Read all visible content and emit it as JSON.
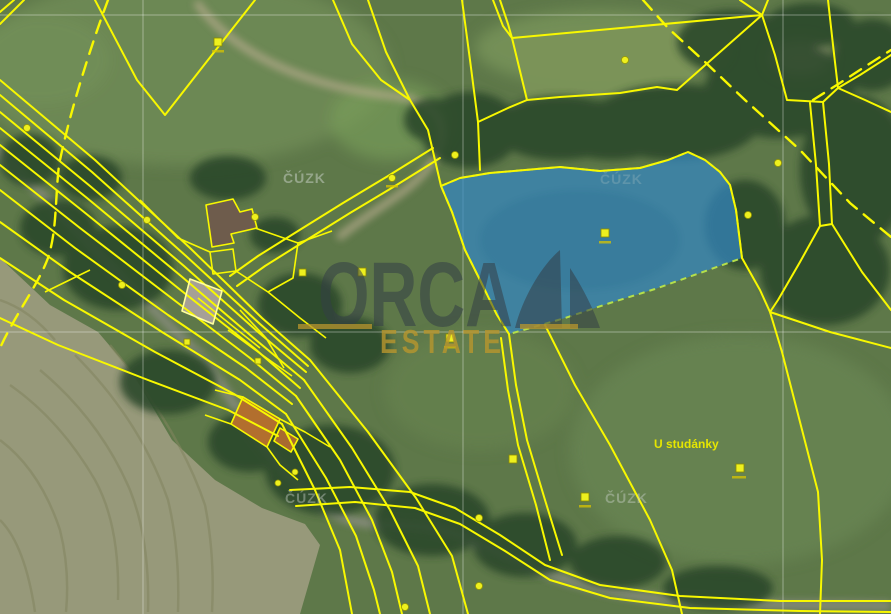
{
  "map": {
    "type": "cadastral-parcel-map-over-aerial-imagery",
    "labels": {
      "cuzk": "ČÚZK",
      "place_name": "U studánky"
    },
    "watermark": {
      "brand_top": "ORCA",
      "brand_bottom": "ESTATE"
    },
    "colors": {
      "parcel_line": "#f8f800",
      "highlight_parcel_fill": "#3387c2",
      "highlight_parcel_outline": "#b5e04a",
      "graticule": "#ffffff",
      "cuzk_label": "#ccd3cc",
      "place_label": "#e6e600",
      "watermark_navy": "#343e46",
      "watermark_gold": "#b8962e"
    }
  }
}
